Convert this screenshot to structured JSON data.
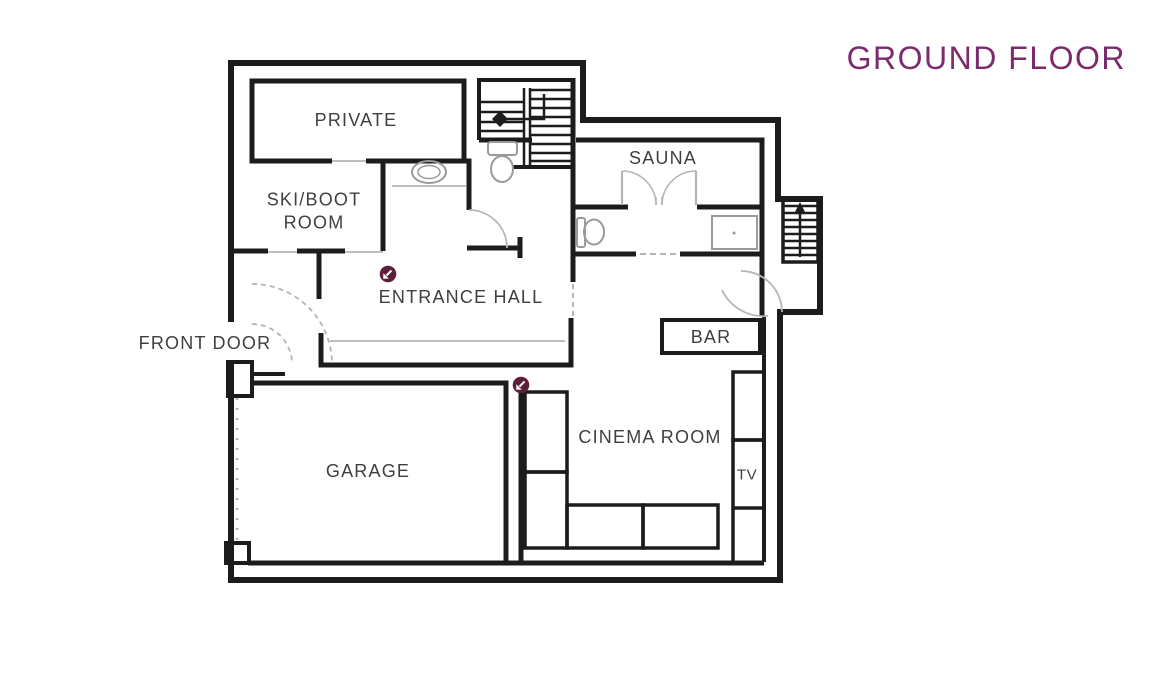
{
  "title": "GROUND FLOOR",
  "colors": {
    "title": "#7B2A6E",
    "walls": "#1C1C1C",
    "labels": "#3F3F3F",
    "fixtures": "#9A9A9A",
    "hotspot": "#5C1F3C"
  },
  "rooms": {
    "private": {
      "label": "PRIVATE"
    },
    "ski_boot_room": {
      "label": "SKI/BOOT ROOM"
    },
    "entrance_hall": {
      "label": "ENTRANCE HALL"
    },
    "front_door": {
      "label": "FRONT DOOR"
    },
    "sauna": {
      "label": "SAUNA"
    },
    "bar": {
      "label": "BAR"
    },
    "cinema_room": {
      "label": "CINEMA ROOM"
    },
    "tv": {
      "label": "TV"
    },
    "garage": {
      "label": "GARAGE"
    }
  },
  "icons": {
    "hotspot": "view-arrow-southwest-icon",
    "internal_stairs": "stairs-direction-arrow-icon",
    "external_stairs": "stairs-up-arrow-icon",
    "wc": "toilet-icon",
    "basin": "sink-icon",
    "shower": "shower-icon",
    "shower_tray": "shower-tray-icon"
  }
}
